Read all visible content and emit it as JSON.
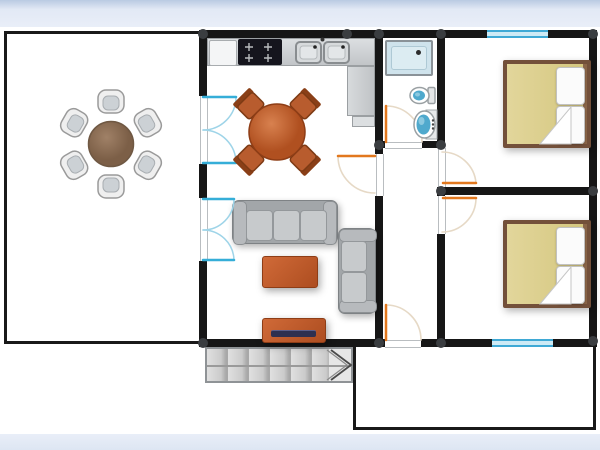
{
  "plan": {
    "kind": "2d-floor-plan",
    "rooms": [
      {
        "id": "patio",
        "name": "patio-dining-room",
        "furniture": [
          "round-wood-table",
          "white-armchair x6"
        ]
      },
      {
        "id": "kitchen",
        "name": "kitchen",
        "furniture": [
          "l-shaped-counter",
          "white-cabinet",
          "cooktop-4-burners",
          "double-sink",
          "round-dining-table",
          "wood-chair x4"
        ]
      },
      {
        "id": "living",
        "name": "living-room",
        "furniture": [
          "sofa-3-seat",
          "loveseat-2-seat",
          "coffee-table",
          "tv-stand-with-tv"
        ]
      },
      {
        "id": "bathroom",
        "name": "bathroom",
        "furniture": [
          "shower",
          "toilet",
          "wash-basin"
        ]
      },
      {
        "id": "hallway",
        "name": "hallway",
        "furniture": []
      },
      {
        "id": "bedroom1",
        "name": "bedroom-top",
        "furniture": [
          "double-bed",
          "pillow x2",
          "sheet-fold"
        ]
      },
      {
        "id": "bedroom2",
        "name": "bedroom-bottom",
        "furniture": [
          "double-bed",
          "pillow x2",
          "sheet-fold"
        ]
      },
      {
        "id": "terrace",
        "name": "terrace",
        "furniture": [
          "staircase-with-direction-arrow"
        ]
      }
    ],
    "openings": {
      "windows": 2,
      "french_double_doors": 2,
      "swing_doors": 5
    }
  },
  "palette": {
    "floor": "#ffffff",
    "wall": "#161616",
    "joint": "#3a3d40",
    "band": "#e9eef8",
    "band_edge": "#bdcde6",
    "window_blue": "#3fa9d5",
    "window_fill": "#cdeaf5",
    "french_door_blue": "#35aed8",
    "french_arc_blue": "#9ed4e8",
    "door_leaf_orange": "#e2781e",
    "door_swing_arc": "#e6d9c6",
    "counter": "#c9ccce",
    "stove": "#15151d",
    "sofa_body": "#a2a6a9",
    "sofa_cushion": "#c7cacc",
    "accent_orange": "#c35c2c",
    "tv_screen": "#2e3050",
    "patio_table_wood": "#8d6e55",
    "kitchen_table_wood": "#c2693a",
    "chair_white": "#efefef",
    "bed_frame": "#73503a",
    "bed_blanket": "#dccf90",
    "pillow": "#fbfbfb",
    "fixture_blue": "#4fa9cd",
    "shower_fill": "#cfe3ec",
    "stair_tread": "#cfcfcf"
  }
}
